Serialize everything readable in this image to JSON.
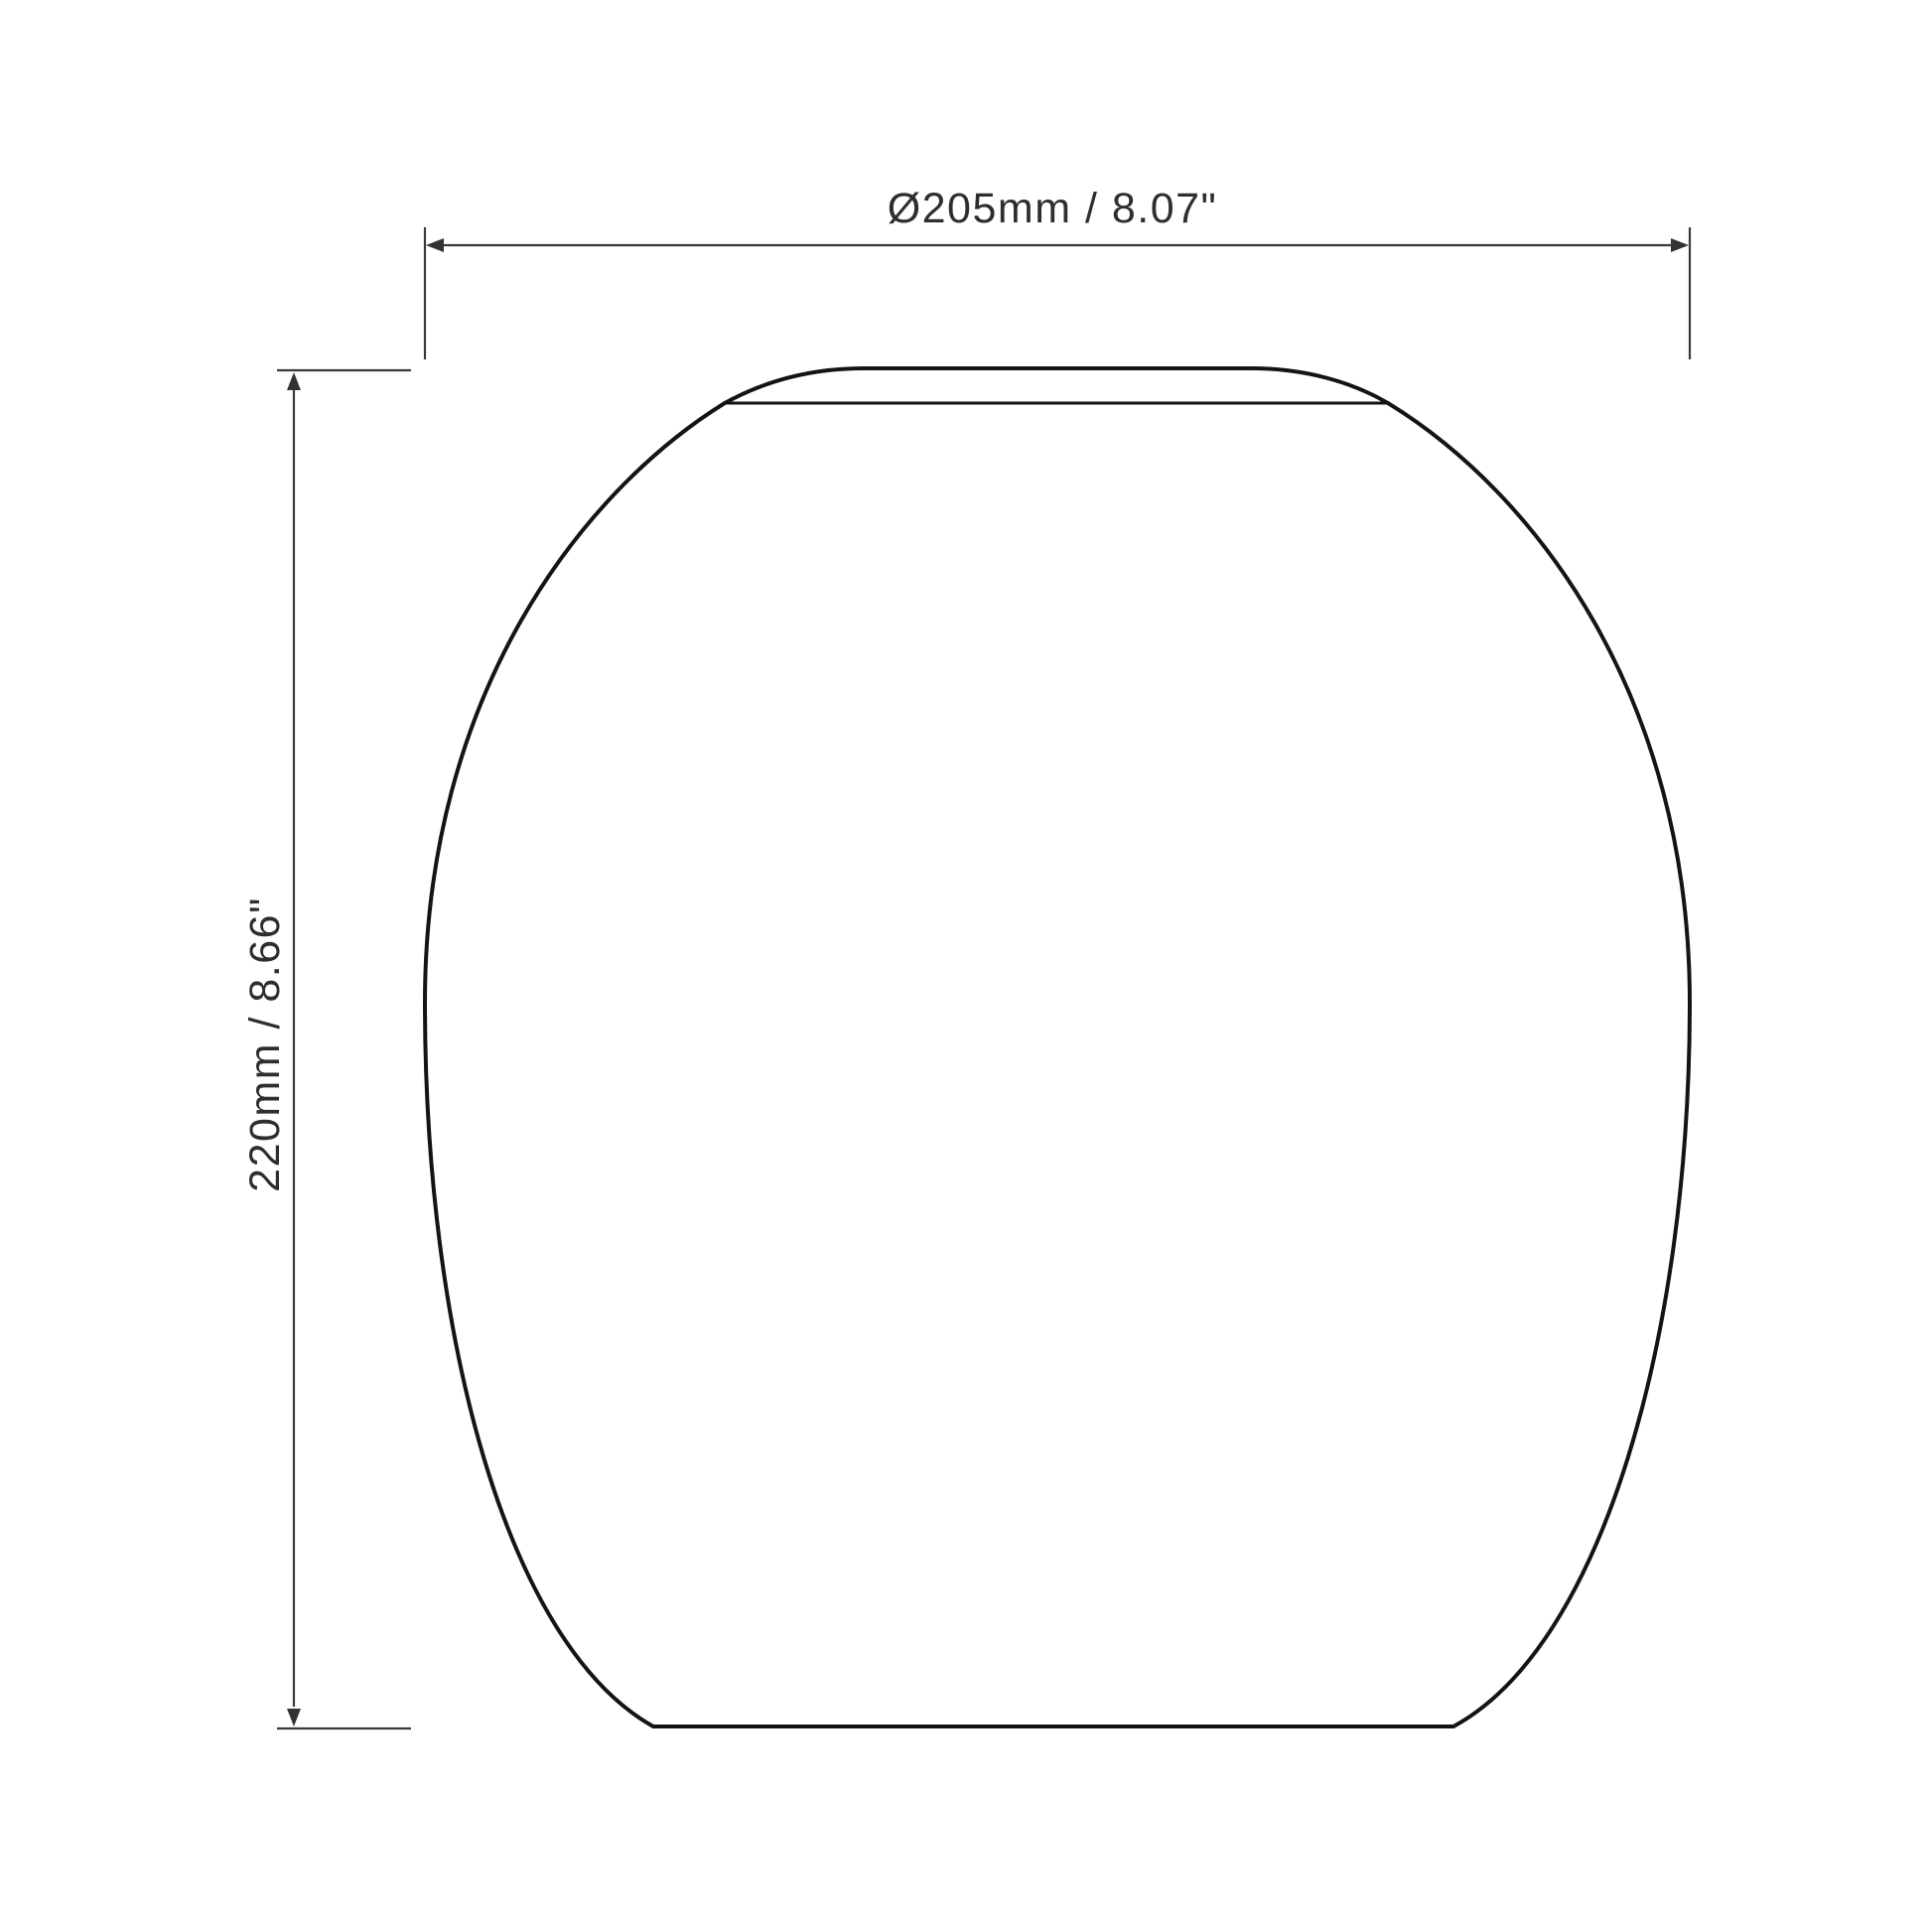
{
  "drawing": {
    "background": "#ffffff",
    "colors": {
      "outline": "#141414",
      "dimension_line": "#3a3a3a",
      "arrow": "#333333",
      "text": "#2e2e2e"
    },
    "dimensions": {
      "diameter": {
        "label": "Ø205mm / 8.07\"",
        "millimeters": "205",
        "inches": "8.07"
      },
      "height": {
        "label": "220mm / 8.66\"",
        "millimeters": "220",
        "inches": "8.66"
      }
    }
  }
}
